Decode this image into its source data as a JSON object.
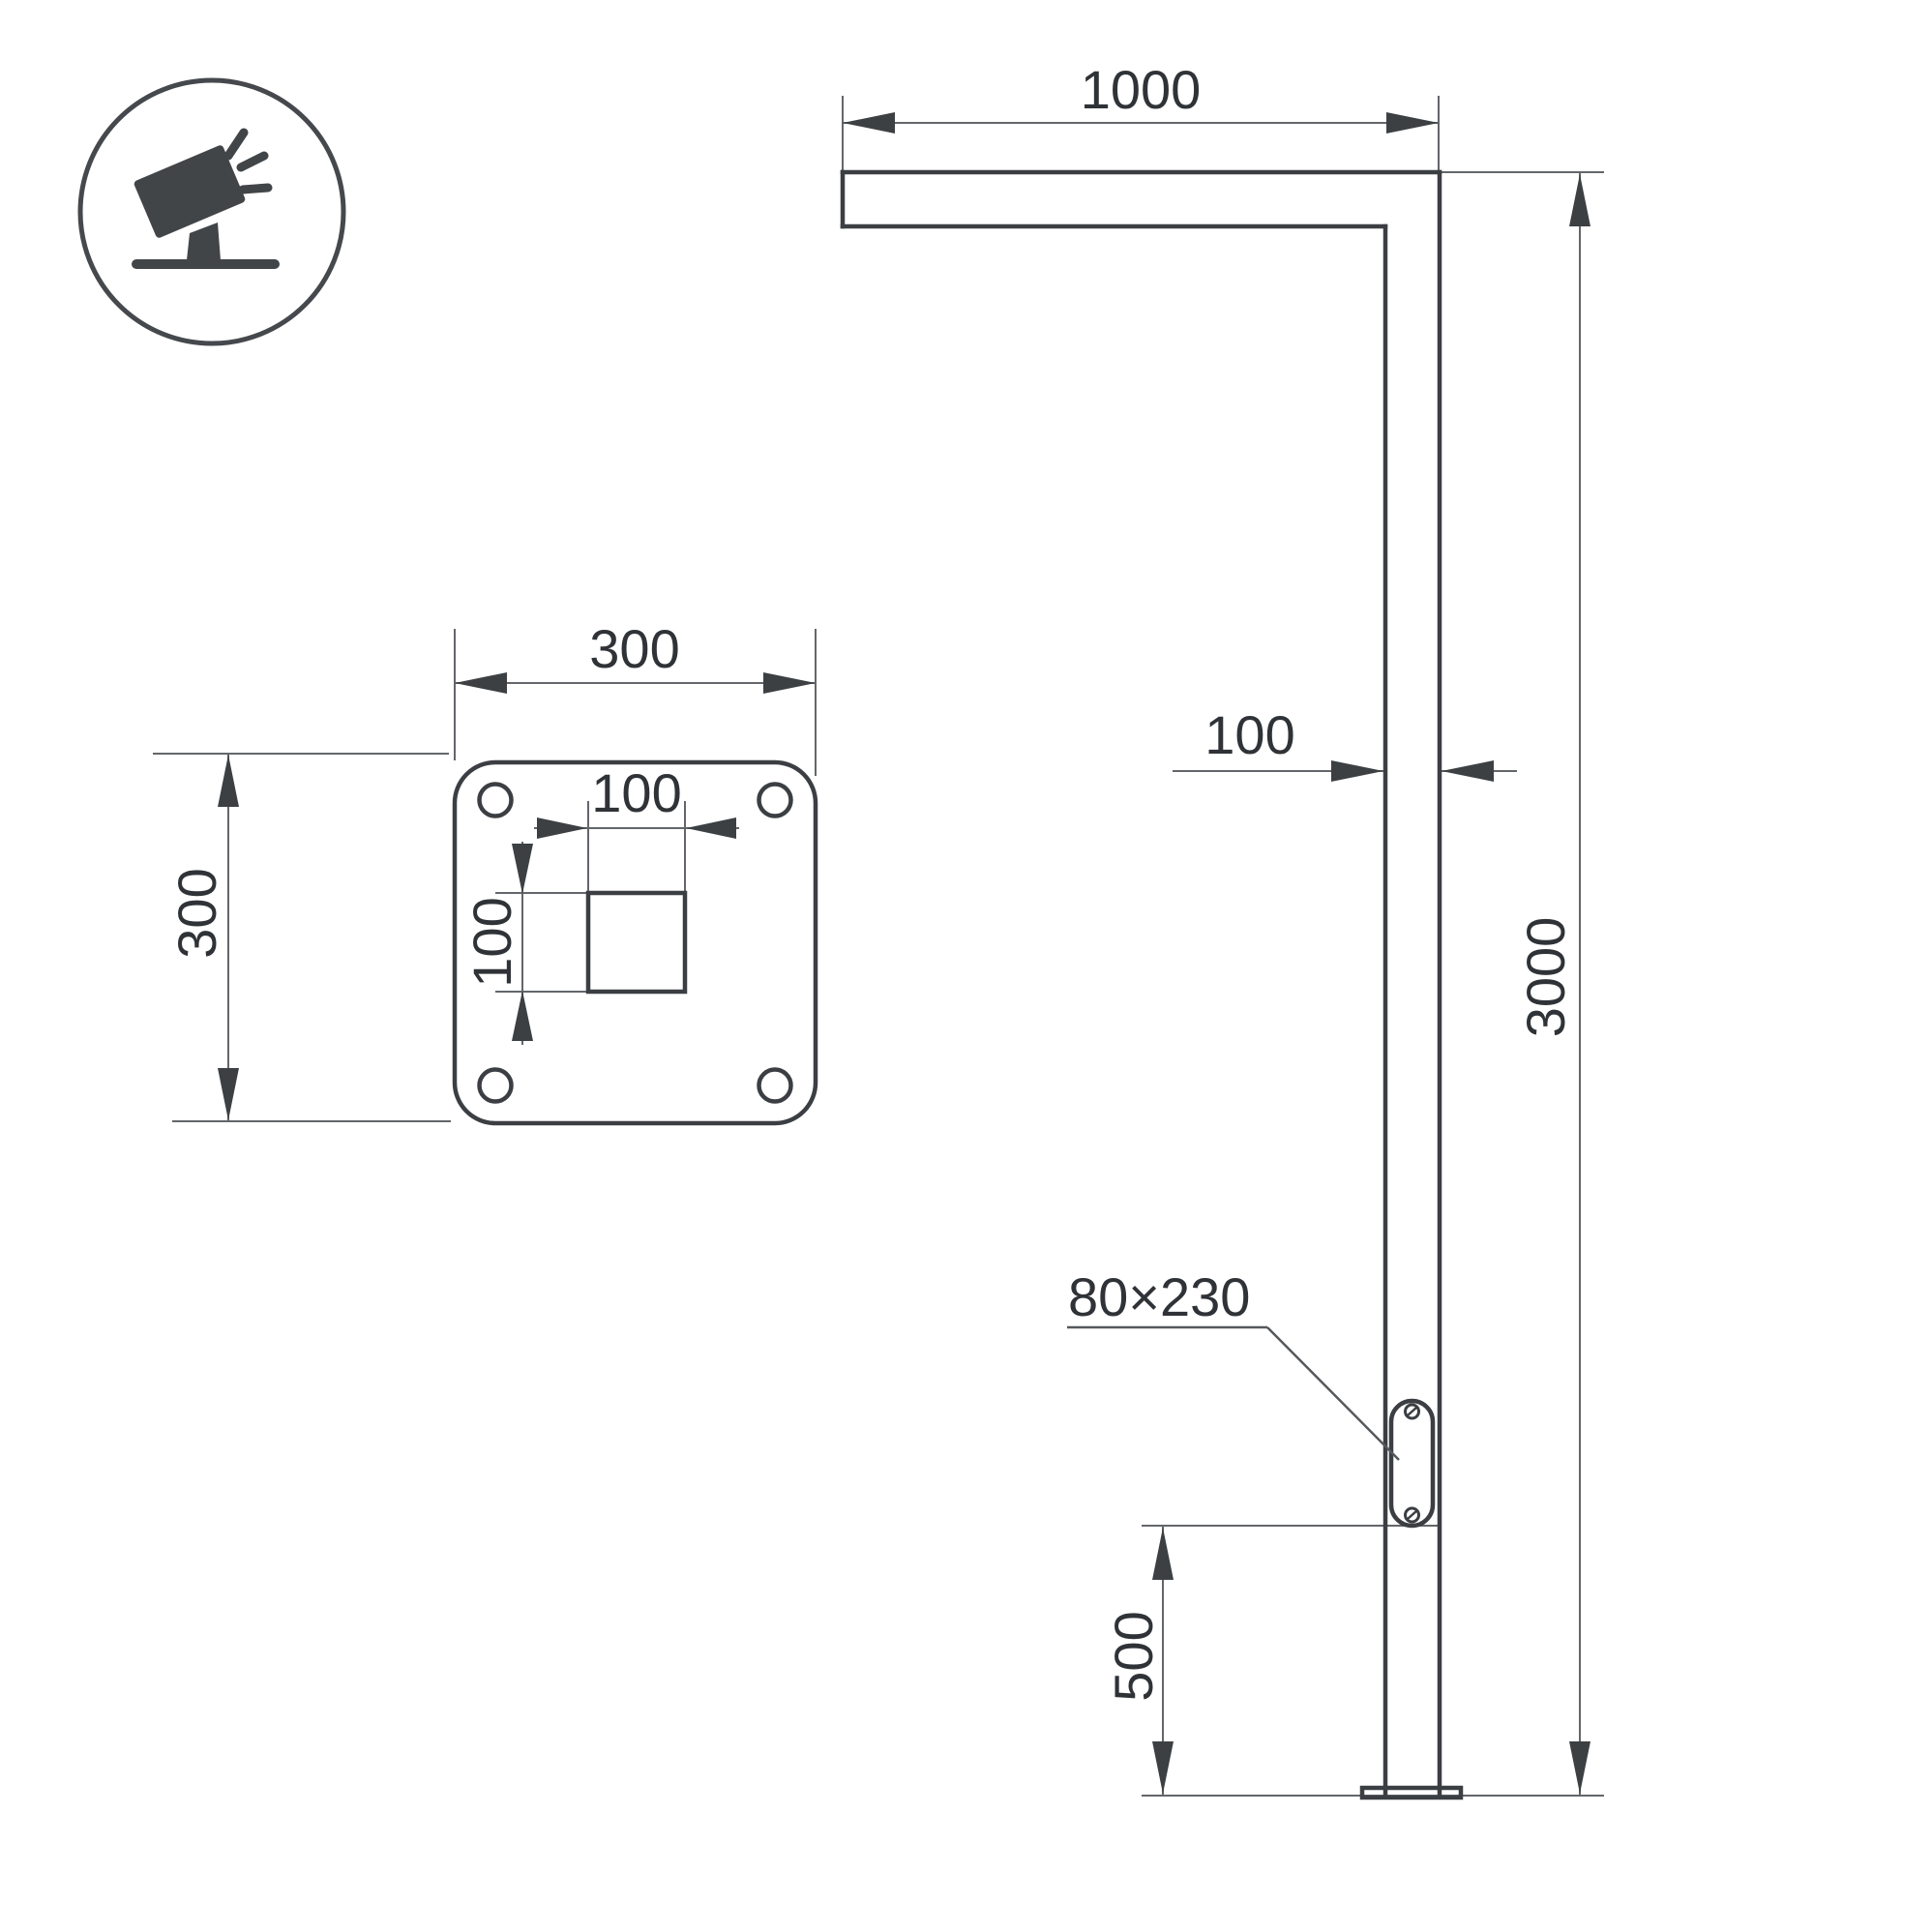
{
  "icon": {
    "name": "tilted-floodlight-icon"
  },
  "pole_view": {
    "arm_length": "1000",
    "pole_width": "100",
    "pole_height": "3000",
    "door_size": "80×230",
    "door_bottom_offset": "500"
  },
  "plate_view": {
    "plate_width": "300",
    "plate_height": "300",
    "hole_width": "100",
    "hole_height": "100"
  },
  "colors": {
    "background": "#ffffff",
    "object_line": "#3b3e42",
    "dimension_line": "#63666a",
    "label_text": "#2f3337",
    "icon": "#424548"
  }
}
